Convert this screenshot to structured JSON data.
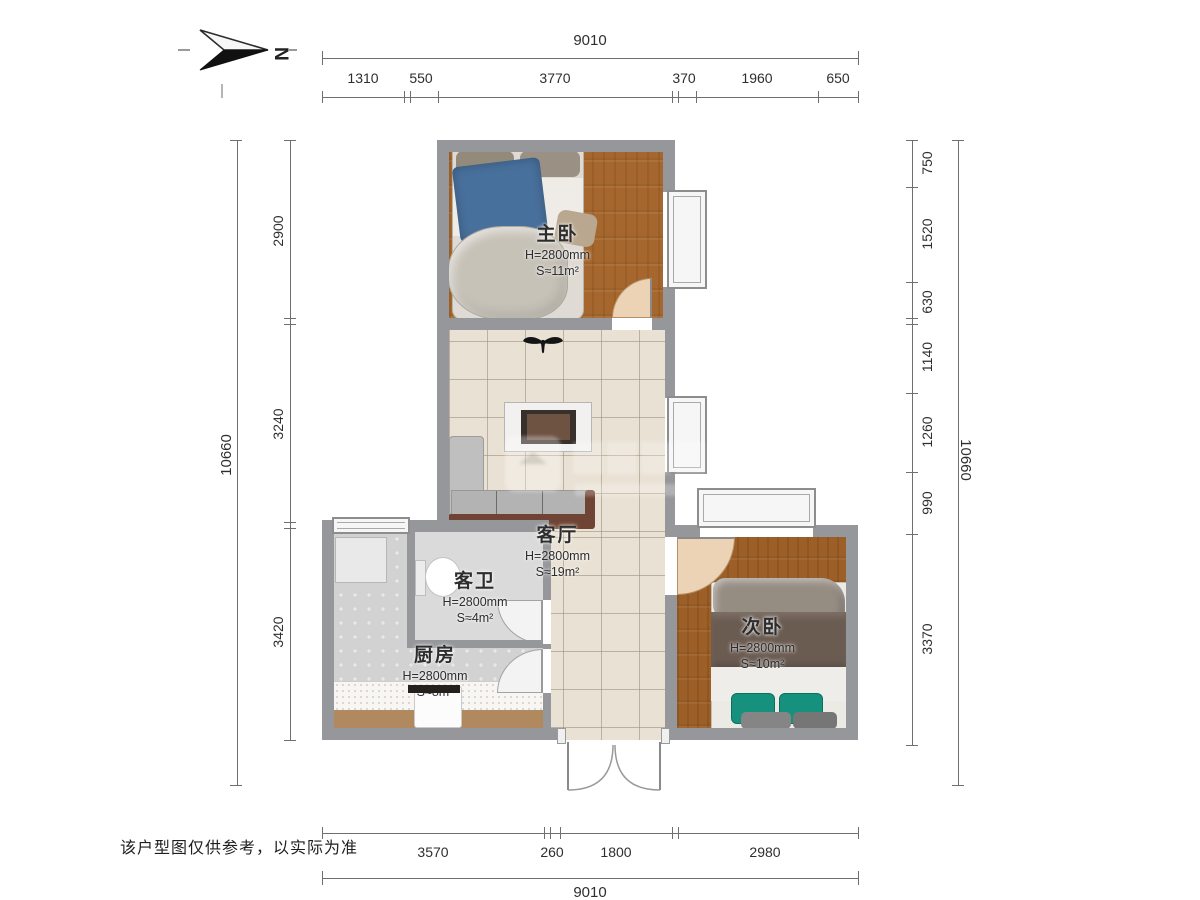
{
  "compass": {
    "label": "N"
  },
  "disclaimer": "该户型图仅供参考，以实际为准",
  "rooms": [
    {
      "id": "master-bedroom",
      "name": "主卧",
      "height": "H=2800mm",
      "area": "S≈11m²"
    },
    {
      "id": "living-room",
      "name": "客厅",
      "height": "H=2800mm",
      "area": "S≈19m²"
    },
    {
      "id": "guest-bathroom",
      "name": "客卫",
      "height": "H=2800mm",
      "area": "S≈4m²"
    },
    {
      "id": "kitchen",
      "name": "厨房",
      "height": "H=2800mm",
      "area": "S≈8m²"
    },
    {
      "id": "secondary-bedroom",
      "name": "次卧",
      "height": "H=2800mm",
      "area": "S≈10m²"
    }
  ],
  "dims": {
    "top": {
      "total": "9010",
      "segments": [
        "1310",
        "550",
        "3770",
        "370",
        "1960",
        "650"
      ]
    },
    "bottom": {
      "total": "9010",
      "segments": [
        "3570",
        "260",
        "1800",
        "2980"
      ]
    },
    "left": {
      "total": "10660",
      "segments": [
        "2900",
        "3240",
        "3420"
      ]
    },
    "right": {
      "total": "10660",
      "segments": [
        "750",
        "1520",
        "630",
        "1140",
        "1260",
        "990",
        "3370"
      ]
    }
  },
  "colors": {
    "wall": "#96979a",
    "master_floor": "#a5672e",
    "secondary_floor": "#9c5f27",
    "tile_floor": "#e9e1d4",
    "kitchen_floor": "#d2d2d2",
    "blanket_blue": "#48709c",
    "pillow_teal": "#15917e",
    "door_swing": "#ecd3b5",
    "dim_line": "#6f6f6f"
  },
  "watermark": {
    "visible": true,
    "legible": false
  }
}
